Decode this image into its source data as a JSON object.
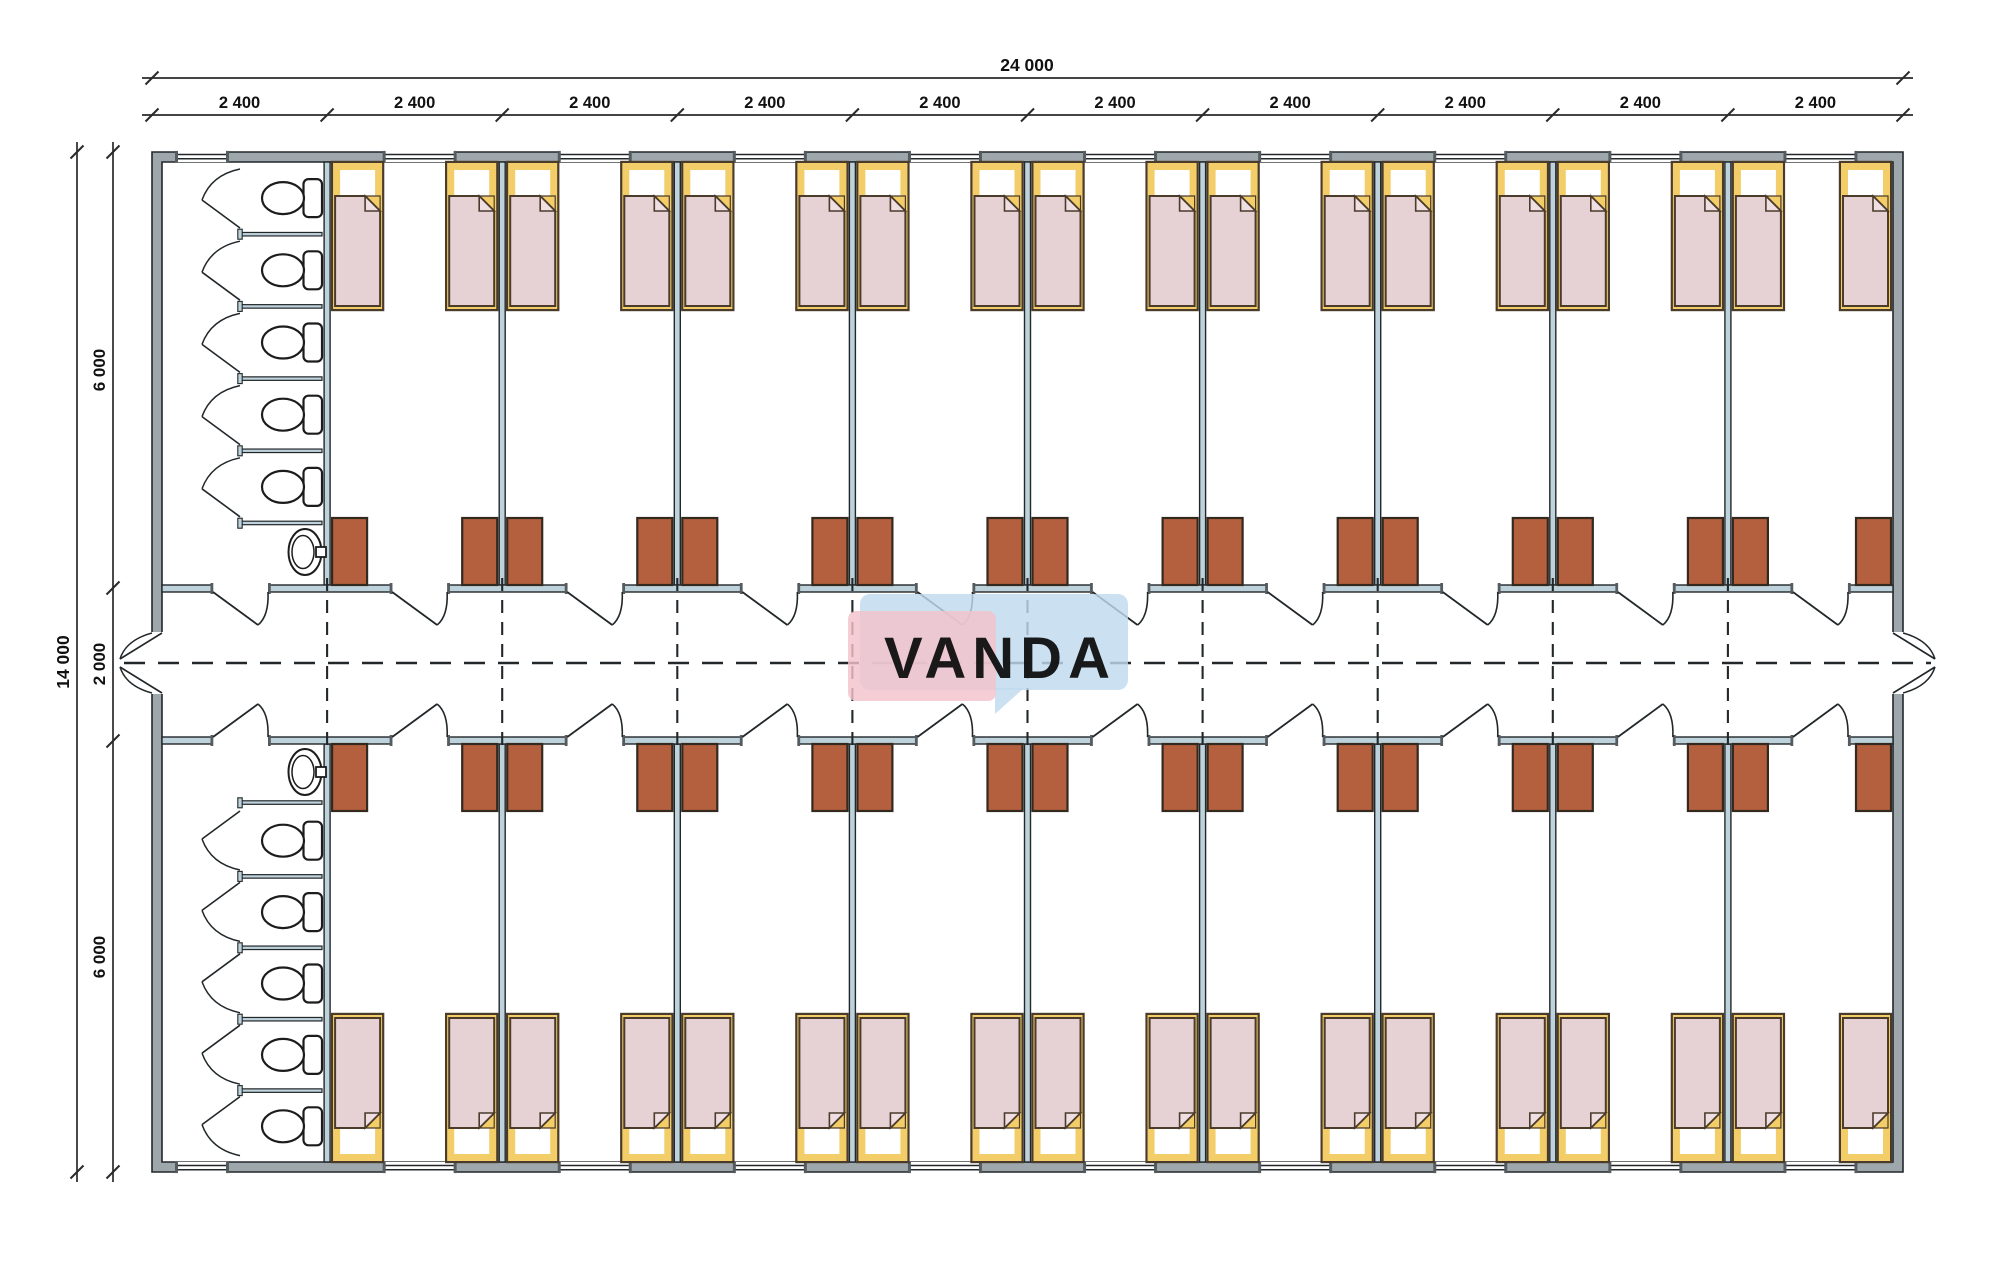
{
  "watermark": {
    "text": "VANDA",
    "pink": "#f3c2ca",
    "blue": "#bfd9ee",
    "text_color": "#ffffff"
  },
  "dimensions": {
    "top_total": "24 000",
    "top_bays": [
      "2 400",
      "2 400",
      "2 400",
      "2 400",
      "2 400",
      "2 400",
      "2 400",
      "2 400",
      "2 400",
      "2 400"
    ],
    "left_total": "14 000",
    "left_sections": [
      "6 000",
      "2 000",
      "6 000"
    ]
  },
  "plan_colors": {
    "background": "#ffffff",
    "line": "#22272a",
    "wall_fill": "#9ea8ac",
    "partition_fill": "#bdd2da",
    "bed_outline": "#4a3b2b",
    "bed_frame_yellow": "#f3cd68",
    "bed_mattress_pink": "#e6d1d4",
    "bed_fold": "#efdfe2",
    "wardrobe_fill": "#b45f3d",
    "wardrobe_outline": "#33291f",
    "fixture_line": "#1c1c1c",
    "dimension_line": "#2a2a2a"
  }
}
